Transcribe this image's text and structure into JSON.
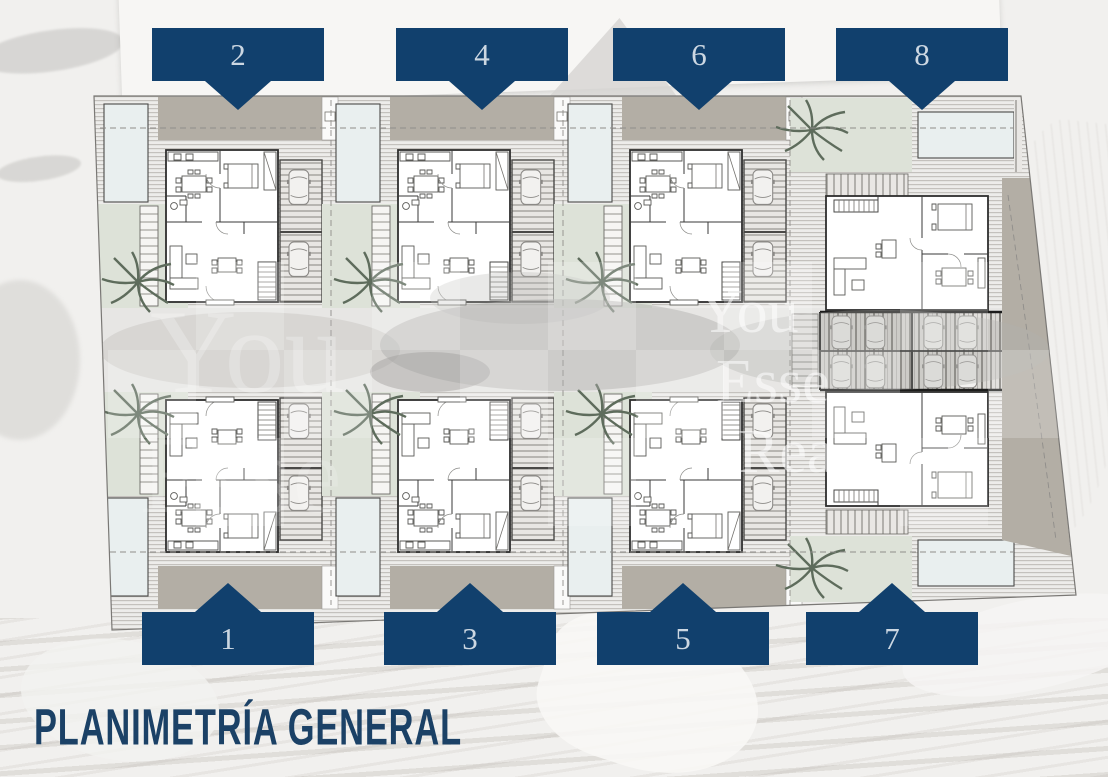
{
  "title": "PLANIMETRÍA GENERAL",
  "plots": {
    "top": [
      {
        "label": "2"
      },
      {
        "label": "4"
      },
      {
        "label": "6"
      },
      {
        "label": "8"
      }
    ],
    "bottom": [
      {
        "label": "1"
      },
      {
        "label": "3"
      },
      {
        "label": "5"
      },
      {
        "label": "7"
      }
    ]
  },
  "watermark": {
    "fragments": [
      "You",
      "Esse",
      "Rea"
    ]
  },
  "colors": {
    "accent_navy": "#11406d",
    "tag_number": "#ccd7e2",
    "title_navy": "#1b4166",
    "driveway_taupe": "#b3aea5",
    "garden_sage": "#dde2d8",
    "pool_blue": "#e9efef"
  }
}
